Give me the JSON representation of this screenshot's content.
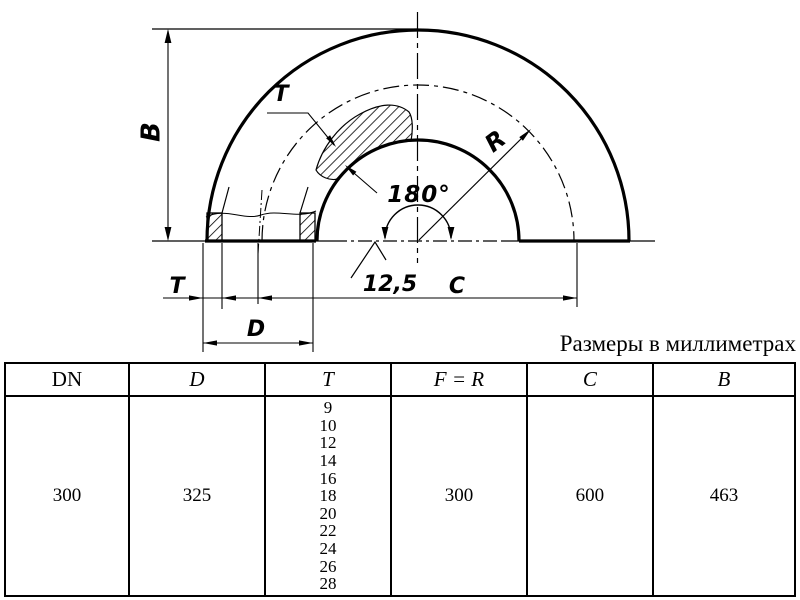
{
  "caption": "Размеры в миллиметрах",
  "drawing": {
    "labels": {
      "b": "B",
      "t_top": "T",
      "r": "R",
      "angle": "180°",
      "note": "12,5",
      "t_bottom": "T",
      "c": "C",
      "d": "D"
    }
  },
  "table": {
    "headers": [
      "DN",
      "D",
      "T",
      "F = R",
      "C",
      "B"
    ],
    "row": {
      "dn": "300",
      "d": "325",
      "t_values": [
        "9",
        "10",
        "12",
        "14",
        "16",
        "18",
        "20",
        "22",
        "24",
        "26",
        "28"
      ],
      "f_r": "300",
      "c": "600",
      "b": "463"
    }
  }
}
